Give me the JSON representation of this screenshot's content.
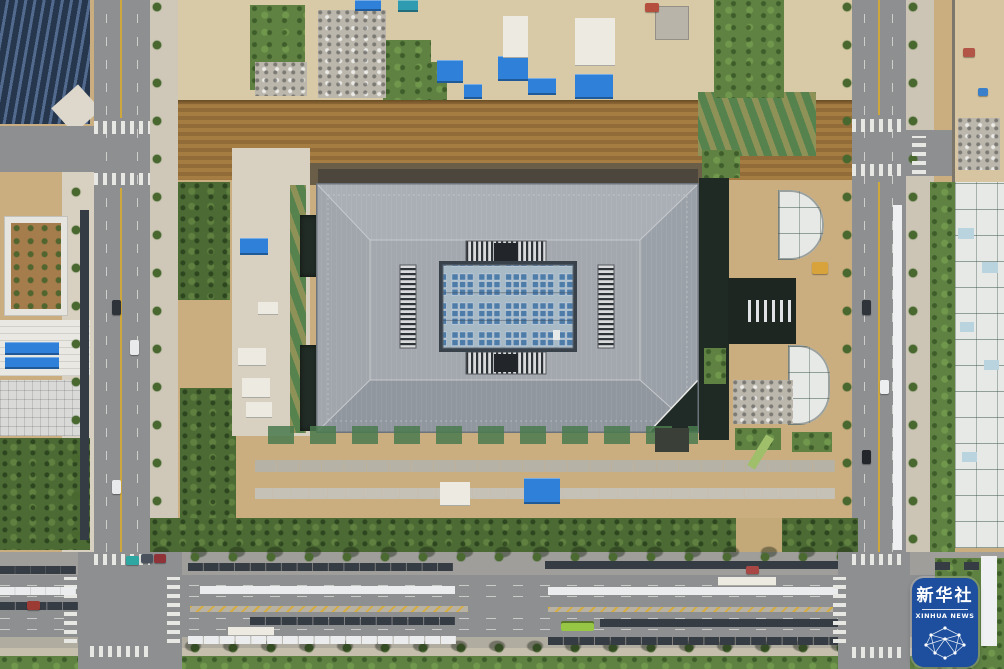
{
  "meta": {
    "type": "aerial-photograph",
    "description": "Top-down drone photograph of a large public building under construction: gray hip roof with central skylight grid, surrounded by construction staging yards, excavation trenches, green netting, and city roads with parked cars on the left, right and bottom"
  },
  "watermark": {
    "name": "新华社",
    "name_en": "XINHUA NEWS",
    "agency": "Xinhua News Agency",
    "badge_color": "#1d4f9e",
    "text_color": "#ffffff"
  },
  "palette": {
    "dirt_tan": "#cbae7f",
    "staging_sand": "#d8caa6",
    "trench_brown": "#a57c42",
    "asphalt_gray": "#8e8f91",
    "roof_gray": "#a0a6ac",
    "skylight_blue": "#a9bac7",
    "skylight_cell_blue": "#4e7ca9",
    "vegetation_green": "#5f8243",
    "netting_green": "#56824e",
    "container_blue": "#2f80d8",
    "lane_yellow": "#cfa83d",
    "bus_green": "#96c643"
  }
}
